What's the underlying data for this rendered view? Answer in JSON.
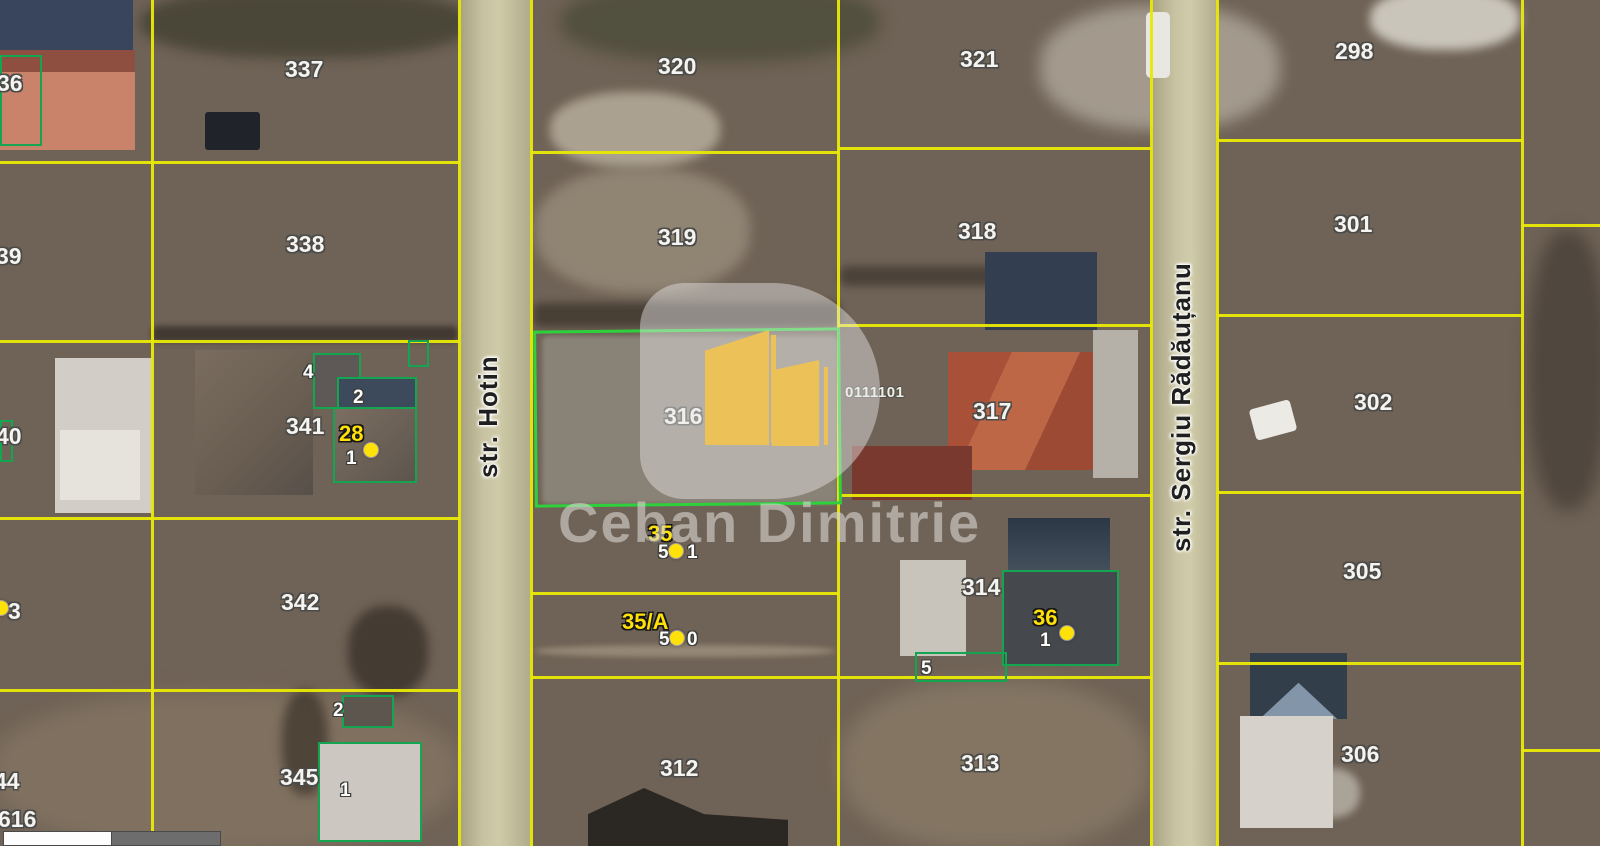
{
  "watermark": {
    "owner_text": "Ceban Dimitrie",
    "cadastral_code": "0111101"
  },
  "streets": {
    "hotin": "str. Hotin",
    "sergiu_radautanu": "str. Sergiu Rădăuțanu"
  },
  "parcel_labels": {
    "p336": "36",
    "p337": "337",
    "p320": "320",
    "p321": "321",
    "p298": "298",
    "p339": "39",
    "p338": "338",
    "p319": "319",
    "p318": "318",
    "p301": "301",
    "p340": "40",
    "p341": "341",
    "p316": "316",
    "p317": "317",
    "p302": "302",
    "p343": "3",
    "p342": "342",
    "p314": "314",
    "p305": "305",
    "p344": "44",
    "p345": "345",
    "p312": "312",
    "p313": "313",
    "p306": "306",
    "p616": "616"
  },
  "markers": {
    "m28": {
      "number": "28",
      "house": "1"
    },
    "m35": {
      "number": "35",
      "digit_left": "5",
      "digit_right": "1"
    },
    "m35a": {
      "number": "35/A",
      "digit_left": "5",
      "digit_right": "0"
    },
    "m36": {
      "number": "36",
      "house": "1"
    }
  },
  "building_labels": {
    "label_4_341": "4",
    "label_2_341": "2",
    "label_2_345": "2",
    "label_1_345": "1",
    "label_5_314": "5"
  },
  "colors": {
    "cadastral_line": "#e9e905",
    "parcel_highlight": "#2ed13c",
    "building_outline": "#14a551",
    "marker_yellow": "#ffe10a",
    "logo_gold": "#ecc157",
    "road": "#c2bd9c"
  }
}
